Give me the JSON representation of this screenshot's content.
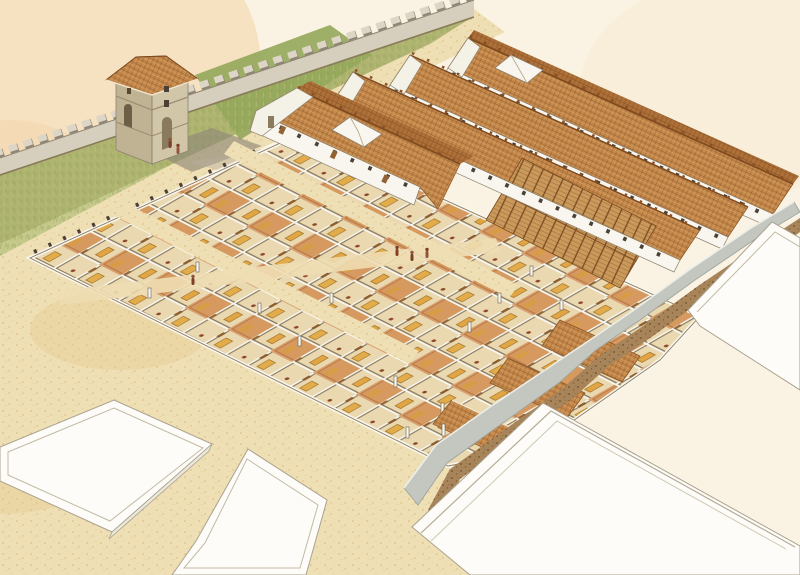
{
  "scene": {
    "type": "watercolor-axonometric-reconstruction",
    "subject": "Roman fort quarter with gate tower, curtain wall, cut-away barrack blocks, tiled storehouse ranges, precinct wall and blank street slabs",
    "visible_text": [],
    "elements": {
      "curtain_wall": {
        "style": "crenellated",
        "direction": "upper-right to left edge"
      },
      "gate_tower": {
        "storeys": 3,
        "roof": "hipped-tile",
        "openings": [
          "arched-door-front",
          "arched-door-side",
          "small-windows"
        ]
      },
      "rampart_grass": {
        "position": "inside curtain wall"
      },
      "parade_ground": {
        "texture": "sand-speckle"
      },
      "barrack_grid": {
        "state": "roofless-cutaway",
        "contents": [
          "tan-floors",
          "orange-floors",
          "gold-furniture",
          "doors",
          "figures"
        ]
      },
      "roofed_ranges": {
        "count": 4,
        "courtyard_openings": 2,
        "rafter_cutaways": 2,
        "windows": "small-dark-slits",
        "porticoes": true
      },
      "precinct_wall": {
        "color_role": "grayWall"
      },
      "street_slabs": {
        "count": 4,
        "style": "blank-white-raised"
      },
      "figures_positions": [
        [
          170,
          141
        ],
        [
          178,
          147
        ],
        [
          193,
          278
        ],
        [
          397,
          249
        ],
        [
          412,
          254
        ],
        [
          427,
          251
        ]
      ]
    }
  },
  "palette": {
    "paper": "#faf3e3",
    "wash": "#f2cf9e",
    "sand": "#efdfb4",
    "sandDeep": "#e2c489",
    "grass": "#c6c98c",
    "grassDark": "#aab06c",
    "grassDeep": "#93a75a",
    "wallFace": "#d6cfbd",
    "wallLight": "#ddd6c6",
    "wallShadowLine": "#8a7a5e",
    "towerLight": "#d2c6a9",
    "towerDark": "#c0b394",
    "roof": "#c68a4d",
    "roofDark": "#ad7038",
    "roofLine": "#7d4a1f",
    "rafter": "#c99a5c",
    "white": "#f8f6ee",
    "whiteShade": "#e2ded0",
    "outline": "#8c8270",
    "floor": "#ead9b0",
    "floorOrange": "#cd7f3f",
    "gold": "#e3aa45",
    "door": "#936233",
    "windowDark": "#4a4036",
    "grayWall": "#c3c7c0",
    "grayWallDark": "#9fa49d",
    "dirt": "#a8845a",
    "slab": "#fdfcf8",
    "slabLine": "#aaa28e",
    "slabSide": "#ebe8db",
    "shadow": "#8f8878",
    "figure": "#7a4028"
  }
}
